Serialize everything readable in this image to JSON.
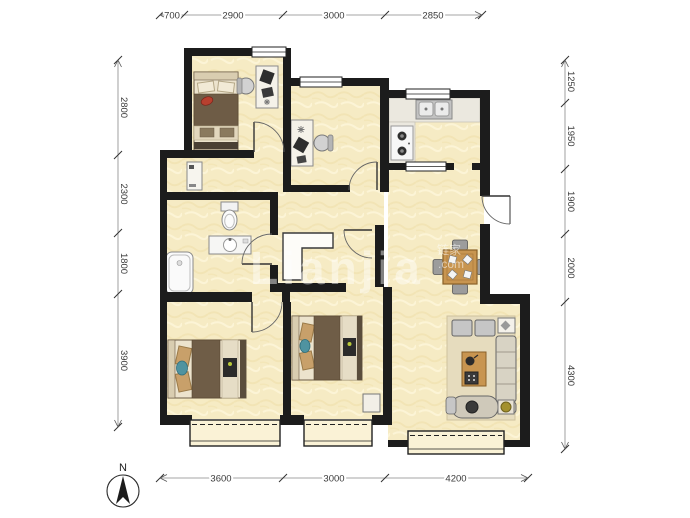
{
  "dimensions": {
    "top": [
      "700",
      "2900",
      "3000",
      "2850"
    ],
    "bottom": [
      "3600",
      "3000",
      "4200"
    ],
    "left": [
      "2800",
      "2300",
      "1800",
      "3900"
    ],
    "right": [
      "1250",
      "1950",
      "1900",
      "2000",
      "4300"
    ]
  },
  "compass": {
    "label": "N"
  },
  "watermark": {
    "text": "Lianjia",
    "cjk": "链家",
    "suffix": ".com"
  },
  "colors": {
    "wall": "#1c1c1c",
    "floor": "#f6ebc4",
    "wood": "#c89550",
    "dimension": "#3a3a3a"
  }
}
